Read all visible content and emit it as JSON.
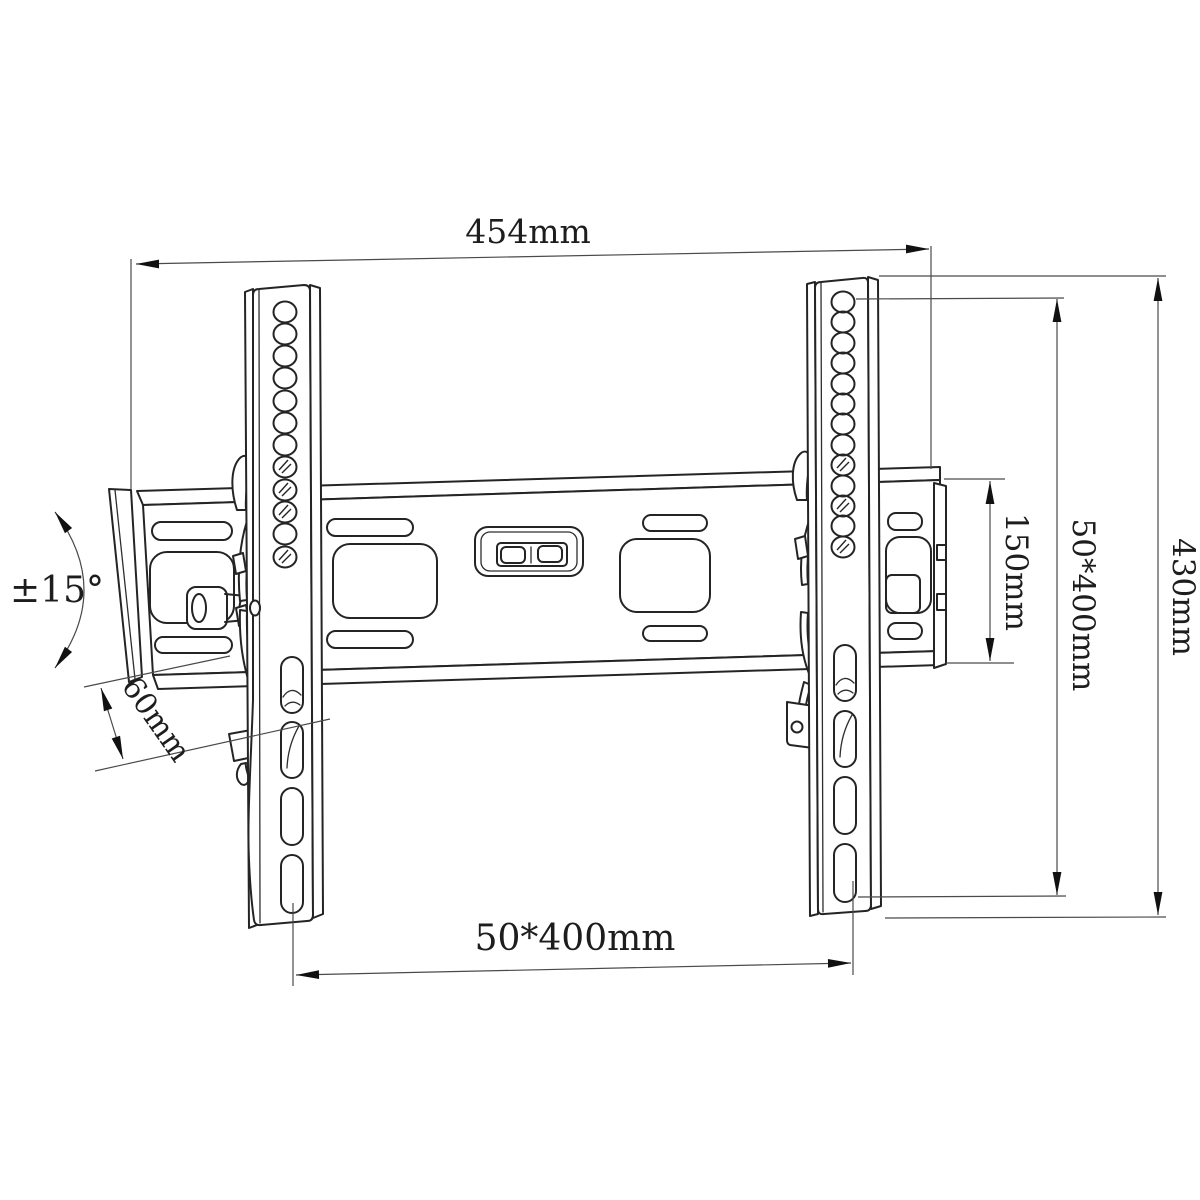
{
  "drawing": {
    "subject": "tilting TV wall mount bracket - dimensioned technical drawing",
    "background": "#ffffff",
    "line_color": "#242424",
    "dimensions": {
      "overall_width": "454mm",
      "tilt_range": "±15°",
      "profile_depth": "60mm",
      "wall_plate_height": "150mm",
      "vesa_vertical": "50*400mm",
      "bracket_height": "430mm",
      "vesa_horizontal": "50*400mm"
    }
  }
}
